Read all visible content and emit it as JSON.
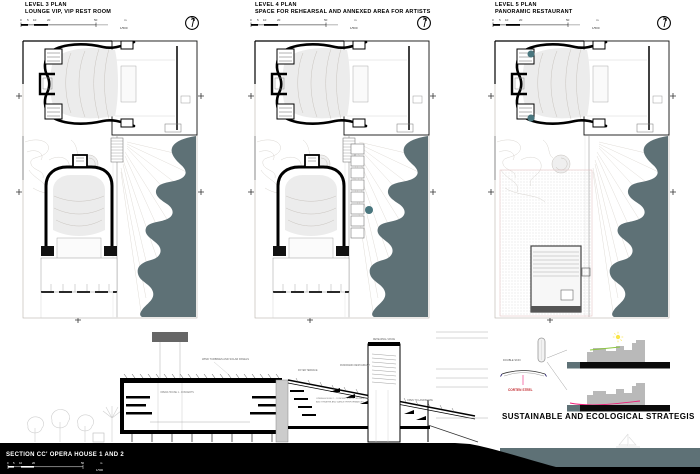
{
  "sheet": {
    "background": "#ffffff"
  },
  "colors": {
    "water": "#5e7176",
    "ink": "#000000",
    "seating_gray": "#ececec",
    "contour_gray": "#d9d5d0",
    "accent_teal": "#49767e",
    "detail_building_gray": "#b9b9b9",
    "eco_green": "#8cc63f",
    "eco_pink": "#ed1e79",
    "corten_red": "#c1272d",
    "sun_yellow": "#f9e54a"
  },
  "scalebar": {
    "ticks": [
      "0",
      "5",
      "10",
      "20",
      "50"
    ],
    "unit": "m",
    "ratio": "1/500"
  },
  "plans": [
    {
      "title": "LEVEL 3 PLAN",
      "subtitle": "LOUNGE VIP, VIP REST ROOM"
    },
    {
      "title": "LEVEL 4 PLAN",
      "subtitle": "SPACE FOR REHEARSAL AND ANNEXED AREA FOR ARTISTS"
    },
    {
      "title": "LEVEL 5 PLAN",
      "subtitle": "PANORAMIC RESTAURANT"
    }
  ],
  "section": {
    "title": "SECTION CC' OPERA HOUSE 1 AND 2",
    "labels": {
      "roof": "WIND TURBINES AND SOLAR PANELS",
      "hall1": "OPERA HOUSE 1 - CONCERTS",
      "hall2_line1": "OPERA HOUSE 2 - CONCERTS WITH ORCHESTRA",
      "hall2_line2": "AND THEATRE AND DANCE PERFORMANCES",
      "foyer": "FOYER TERRACE",
      "restaurant": "PANORAMIC RESTAURANT",
      "tower": "REHEARSAL SPACE",
      "landscape": "OPEN TO LANDSCAPE"
    }
  },
  "eco": {
    "title": "SUSTAINABLE AND ECOLOGICAL STRATEGIS",
    "double_skin": "DOUBLE SKIN",
    "corten": "CORTEN STEEL"
  }
}
